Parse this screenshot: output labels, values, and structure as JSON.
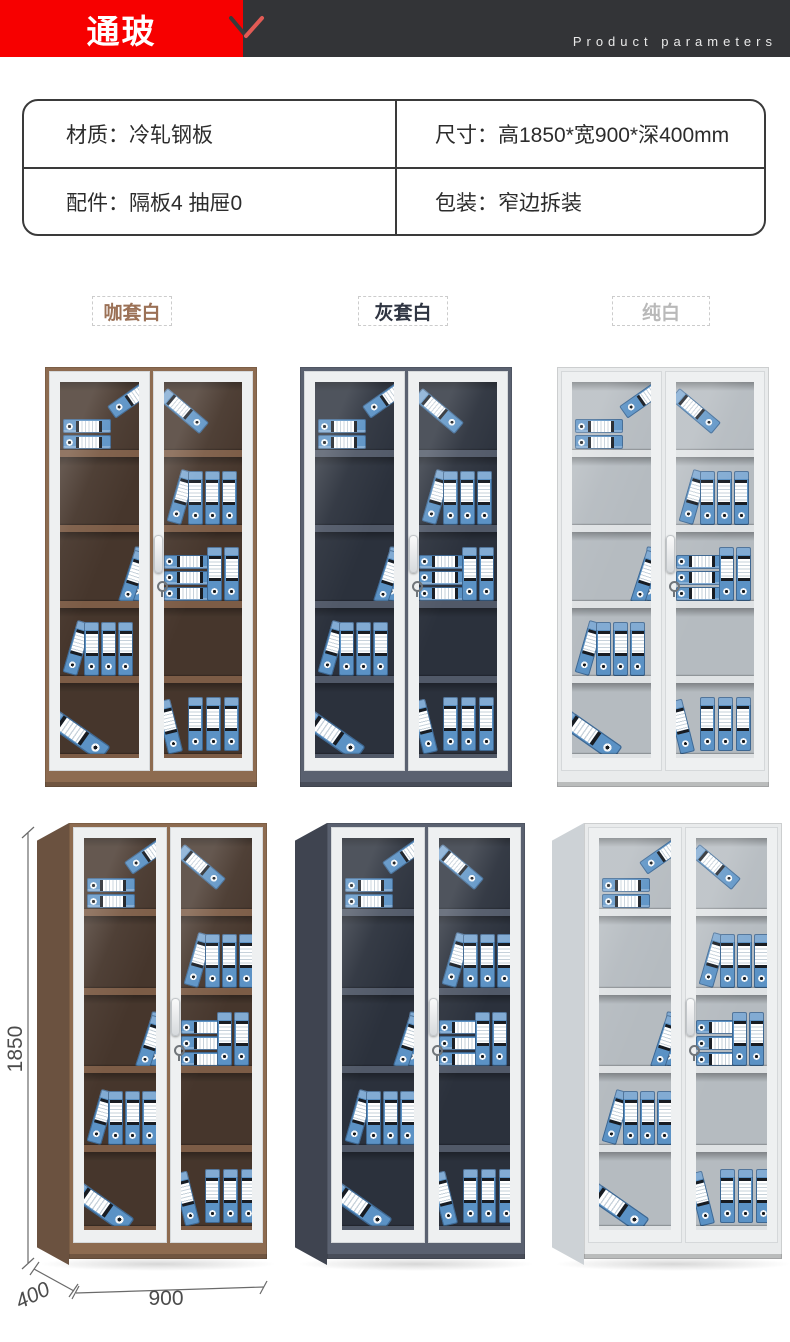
{
  "header": {
    "brand": "通玻",
    "subtitle": "Product parameters",
    "brand_bg": "#f70000",
    "bar_bg": "#333437"
  },
  "params": {
    "material": "材质：冷轧钢板",
    "size": "尺寸：高1850*宽900*深400mm",
    "accessories": "配件：隔板4  抽屉0",
    "packing": "包装：窄边拆装"
  },
  "variants": [
    {
      "key": "cafe-white",
      "label": "咖套白",
      "label_color": "#9b7156",
      "body": "#8d6b50",
      "side": "#6b5240",
      "interior": "#46362c",
      "shelf": "#7c5c46"
    },
    {
      "key": "gray-white",
      "label": "灰套白",
      "label_color": "#2f3542",
      "body": "#5a6170",
      "side": "#3f4450",
      "interior": "#2b313c",
      "shelf": "#515968"
    },
    {
      "key": "pure-white",
      "label": "纯白",
      "label_color": "#b9b9b9",
      "body": "#e9ebec",
      "side": "#cdd2d6",
      "interior": "#b5bbc0",
      "shelf": "#dfe2e4"
    }
  ],
  "dimensions": {
    "height": "1850",
    "depth": "400",
    "width": "900"
  },
  "colors": {
    "binder_blue": "#5b92c5",
    "binder_blue_light": "#82abd3",
    "check_dark": "#3a3a3a",
    "check_red": "#e25b55"
  }
}
